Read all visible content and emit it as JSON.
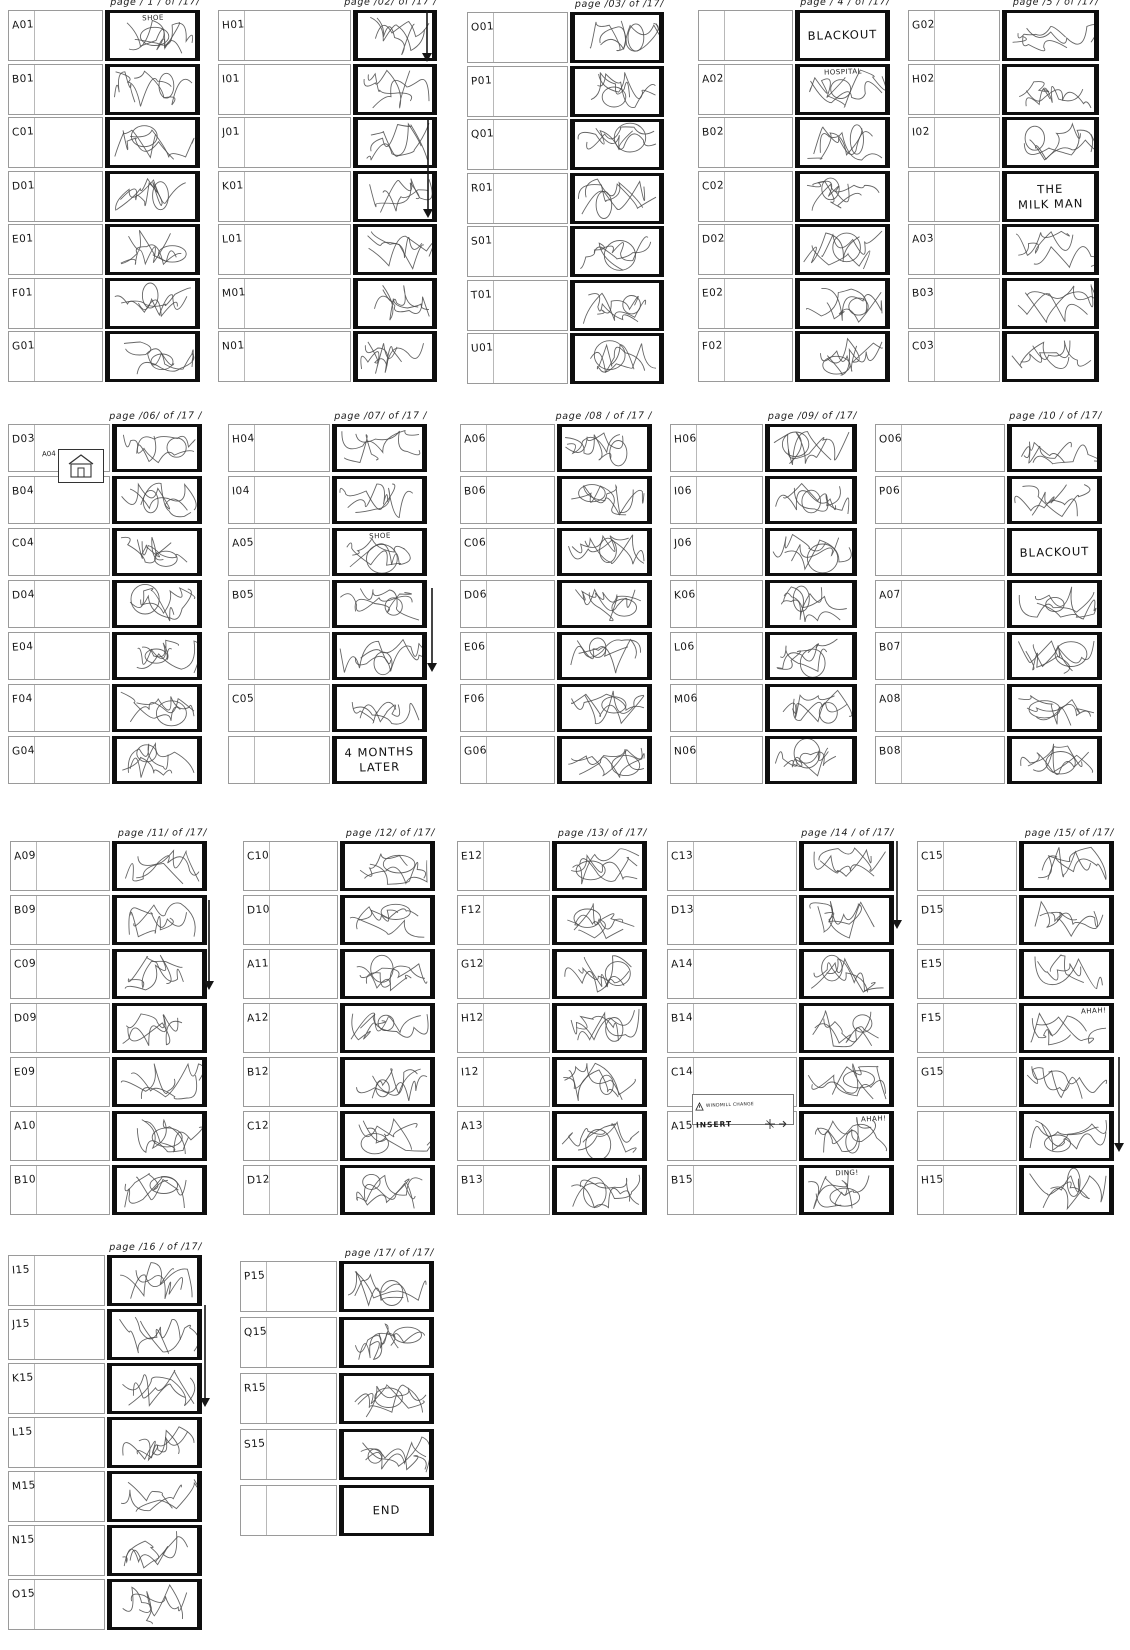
{
  "sheet_colors": {
    "frame_border": "#0e0e0e",
    "note_border": "#9a9a9a",
    "ink": "#1a1a1a",
    "sketch_stroke": "#4a4a4a"
  },
  "insets": {
    "house": {
      "label": "A04",
      "name": "house-doodle"
    },
    "insert_note": {
      "heading": "INSERT",
      "note": "WINDMILL CHANGE"
    }
  },
  "pages": [
    {
      "num": "1",
      "header": "page / 1 / of /17/",
      "rows": [
        {
          "label": "A01",
          "type": "sketch",
          "overlay": "SHOE"
        },
        {
          "label": "B01",
          "type": "sketch"
        },
        {
          "label": "C01",
          "type": "sketch"
        },
        {
          "label": "D01",
          "type": "sketch"
        },
        {
          "label": "E01",
          "type": "sketch"
        },
        {
          "label": "F01",
          "type": "sketch"
        },
        {
          "label": "G01",
          "type": "sketch"
        }
      ]
    },
    {
      "num": "2",
      "header": "page /02/ of /17 /",
      "rows": [
        {
          "label": "H01",
          "type": "sketch"
        },
        {
          "label": "I01",
          "type": "sketch"
        },
        {
          "label": "J01",
          "type": "sketch"
        },
        {
          "label": "K01",
          "type": "sketch"
        },
        {
          "label": "L01",
          "type": "sketch"
        },
        {
          "label": "M01",
          "type": "sketch"
        },
        {
          "label": "N01",
          "type": "sketch"
        }
      ]
    },
    {
      "num": "3",
      "header": "page /03/ of /17/",
      "rows": [
        {
          "label": "O01",
          "type": "sketch"
        },
        {
          "label": "P01",
          "type": "sketch"
        },
        {
          "label": "Q01",
          "type": "sketch"
        },
        {
          "label": "R01",
          "type": "sketch"
        },
        {
          "label": "S01",
          "type": "sketch"
        },
        {
          "label": "T01",
          "type": "sketch"
        },
        {
          "label": "U01",
          "type": "sketch"
        }
      ]
    },
    {
      "num": "4",
      "header": "page / 4 / of /17/",
      "rows": [
        {
          "label": "",
          "type": "text",
          "lines": [
            "BLACKOUT"
          ]
        },
        {
          "label": "A02",
          "type": "sketch",
          "overlay": "HOSPITAL"
        },
        {
          "label": "B02",
          "type": "sketch"
        },
        {
          "label": "C02",
          "type": "sketch"
        },
        {
          "label": "D02",
          "type": "sketch"
        },
        {
          "label": "E02",
          "type": "sketch"
        },
        {
          "label": "F02",
          "type": "sketch"
        }
      ]
    },
    {
      "num": "5",
      "header": "page /5 / of /17/",
      "rows": [
        {
          "label": "G02",
          "type": "sketch"
        },
        {
          "label": "H02",
          "type": "sketch"
        },
        {
          "label": "I02",
          "type": "sketch"
        },
        {
          "label": "",
          "type": "text",
          "lines": [
            "THE",
            "MILK MAN"
          ]
        },
        {
          "label": "A03",
          "type": "sketch"
        },
        {
          "label": "B03",
          "type": "sketch"
        },
        {
          "label": "C03",
          "type": "sketch"
        }
      ]
    },
    {
      "num": "6",
      "header": "page /06/ of /17 /",
      "rows": [
        {
          "label": "D03",
          "type": "sketch"
        },
        {
          "label": "B04",
          "type": "sketch"
        },
        {
          "label": "C04",
          "type": "sketch"
        },
        {
          "label": "D04",
          "type": "sketch"
        },
        {
          "label": "E04",
          "type": "sketch"
        },
        {
          "label": "F04",
          "type": "sketch"
        },
        {
          "label": "G04",
          "type": "sketch"
        }
      ]
    },
    {
      "num": "7",
      "header": "page /07/ of /17 /",
      "rows": [
        {
          "label": "H04",
          "type": "sketch"
        },
        {
          "label": "I04",
          "type": "sketch"
        },
        {
          "label": "A05",
          "type": "sketch",
          "overlay": "SHOE"
        },
        {
          "label": "B05",
          "type": "sketch"
        },
        {
          "label": "",
          "type": "sketch"
        },
        {
          "label": "C05",
          "type": "sketch"
        },
        {
          "label": "",
          "type": "text",
          "lines": [
            "4 MONTHS",
            "LATER"
          ]
        }
      ]
    },
    {
      "num": "8",
      "header": "page /08 / of /17 /",
      "rows": [
        {
          "label": "A06",
          "type": "sketch"
        },
        {
          "label": "B06",
          "type": "sketch"
        },
        {
          "label": "C06",
          "type": "sketch"
        },
        {
          "label": "D06",
          "type": "sketch"
        },
        {
          "label": "E06",
          "type": "sketch"
        },
        {
          "label": "F06",
          "type": "sketch"
        },
        {
          "label": "G06",
          "type": "sketch"
        }
      ]
    },
    {
      "num": "9",
      "header": "page /09/ of /17/",
      "rows": [
        {
          "label": "H06",
          "type": "sketch"
        },
        {
          "label": "I06",
          "type": "sketch"
        },
        {
          "label": "J06",
          "type": "sketch"
        },
        {
          "label": "K06",
          "type": "sketch"
        },
        {
          "label": "L06",
          "type": "sketch"
        },
        {
          "label": "M06",
          "type": "sketch"
        },
        {
          "label": "N06",
          "type": "sketch"
        }
      ]
    },
    {
      "num": "10",
      "header": "page /10 / of /17/",
      "rows": [
        {
          "label": "O06",
          "type": "sketch"
        },
        {
          "label": "P06",
          "type": "sketch"
        },
        {
          "label": "",
          "type": "text",
          "lines": [
            "BLACKOUT"
          ]
        },
        {
          "label": "A07",
          "type": "sketch"
        },
        {
          "label": "B07",
          "type": "sketch"
        },
        {
          "label": "A08",
          "type": "sketch"
        },
        {
          "label": "B08",
          "type": "sketch"
        }
      ]
    },
    {
      "num": "11",
      "header": "page /11/ of /17/",
      "rows": [
        {
          "label": "A09",
          "type": "sketch"
        },
        {
          "label": "B09",
          "type": "sketch"
        },
        {
          "label": "C09",
          "type": "sketch"
        },
        {
          "label": "D09",
          "type": "sketch"
        },
        {
          "label": "E09",
          "type": "sketch"
        },
        {
          "label": "A10",
          "type": "sketch"
        },
        {
          "label": "B10",
          "type": "sketch"
        }
      ]
    },
    {
      "num": "12",
      "header": "page /12/ of /17/",
      "rows": [
        {
          "label": "C10",
          "type": "sketch"
        },
        {
          "label": "D10",
          "type": "sketch"
        },
        {
          "label": "A11",
          "type": "sketch"
        },
        {
          "label": "A12",
          "type": "sketch"
        },
        {
          "label": "B12",
          "type": "sketch"
        },
        {
          "label": "C12",
          "type": "sketch"
        },
        {
          "label": "D12",
          "type": "sketch"
        }
      ]
    },
    {
      "num": "13",
      "header": "page /13/ of /17/",
      "rows": [
        {
          "label": "E12",
          "type": "sketch"
        },
        {
          "label": "F12",
          "type": "sketch"
        },
        {
          "label": "G12",
          "type": "sketch"
        },
        {
          "label": "H12",
          "type": "sketch"
        },
        {
          "label": "I12",
          "type": "sketch"
        },
        {
          "label": "A13",
          "type": "sketch"
        },
        {
          "label": "B13",
          "type": "sketch"
        }
      ]
    },
    {
      "num": "14",
      "header": "page /14 / of /17/",
      "rows": [
        {
          "label": "C13",
          "type": "sketch"
        },
        {
          "label": "D13",
          "type": "sketch"
        },
        {
          "label": "A14",
          "type": "sketch"
        },
        {
          "label": "B14",
          "type": "sketch"
        },
        {
          "label": "C14",
          "type": "sketch"
        },
        {
          "label": "A15",
          "type": "sketch",
          "overlay": "AHAH!"
        },
        {
          "label": "B15",
          "type": "sketch",
          "overlay": "DING!"
        }
      ]
    },
    {
      "num": "15",
      "header": "page /15/ of /17/",
      "rows": [
        {
          "label": "C15",
          "type": "sketch"
        },
        {
          "label": "D15",
          "type": "sketch"
        },
        {
          "label": "E15",
          "type": "sketch"
        },
        {
          "label": "F15",
          "type": "sketch",
          "overlay": "AHAH!"
        },
        {
          "label": "G15",
          "type": "sketch"
        },
        {
          "label": "",
          "type": "sketch"
        },
        {
          "label": "H15",
          "type": "sketch"
        }
      ]
    },
    {
      "num": "16",
      "header": "page /16 / of /17/",
      "rows": [
        {
          "label": "I15",
          "type": "sketch"
        },
        {
          "label": "J15",
          "type": "sketch"
        },
        {
          "label": "K15",
          "type": "sketch"
        },
        {
          "label": "L15",
          "type": "sketch"
        },
        {
          "label": "M15",
          "type": "sketch"
        },
        {
          "label": "N15",
          "type": "sketch"
        },
        {
          "label": "O15",
          "type": "sketch"
        }
      ]
    },
    {
      "num": "17",
      "header": "page /17/ of /17/",
      "rows": [
        {
          "label": "P15",
          "type": "sketch"
        },
        {
          "label": "Q15",
          "type": "sketch"
        },
        {
          "label": "R15",
          "type": "sketch"
        },
        {
          "label": "S15",
          "type": "sketch"
        },
        {
          "label": "",
          "type": "text",
          "lines": [
            "END"
          ]
        }
      ]
    }
  ]
}
